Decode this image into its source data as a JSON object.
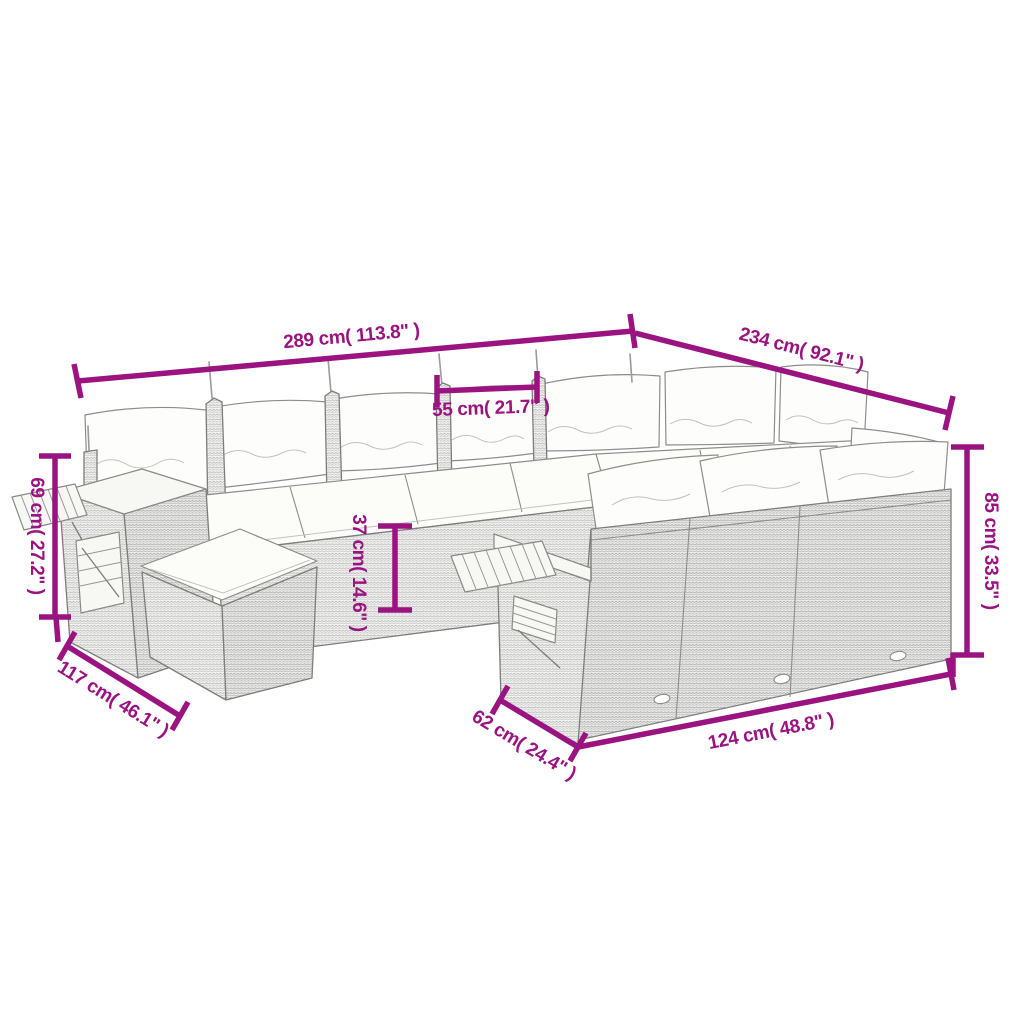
{
  "subject": "Line-drawing dimension diagram of a U-shaped poly-rattan garden lounge set with back pillows, seat cushions, footstool and fold-out wooden trays",
  "colors": {
    "dimension": "#9A1380",
    "sketch_outline": "#7d7d7d",
    "background": "#ffffff"
  },
  "dimensions": {
    "total_width_back": {
      "cm": "289",
      "inches": "113.8",
      "label": "289 cm( 113.8\" )"
    },
    "total_depth_right": {
      "cm": "234",
      "inches": "92.1",
      "label": "234 cm( 92.1\" )"
    },
    "seat_module_width": {
      "cm": "55",
      "inches": "21.7",
      "label": "55 cm( 21.7\" )"
    },
    "armrest_height_left": {
      "cm": "69",
      "inches": "27.2",
      "label": "69 cm( 27.2\" )"
    },
    "back_height_right": {
      "cm": "85",
      "inches": "33.5",
      "label": "85 cm( 33.5\" )"
    },
    "seat_height_middle": {
      "cm": "37",
      "inches": "14.6",
      "label": "37 cm( 14.6\" )"
    },
    "left_section_depth": {
      "cm": "117",
      "inches": "46.1",
      "label": "117 cm( 46.1\" )"
    },
    "front_section_depth": {
      "cm": "62",
      "inches": "24.4",
      "label": "62 cm( 24.4\" )"
    },
    "front_section_width": {
      "cm": "124",
      "inches": "48.8",
      "label": "124 cm( 48.8\" )"
    }
  }
}
